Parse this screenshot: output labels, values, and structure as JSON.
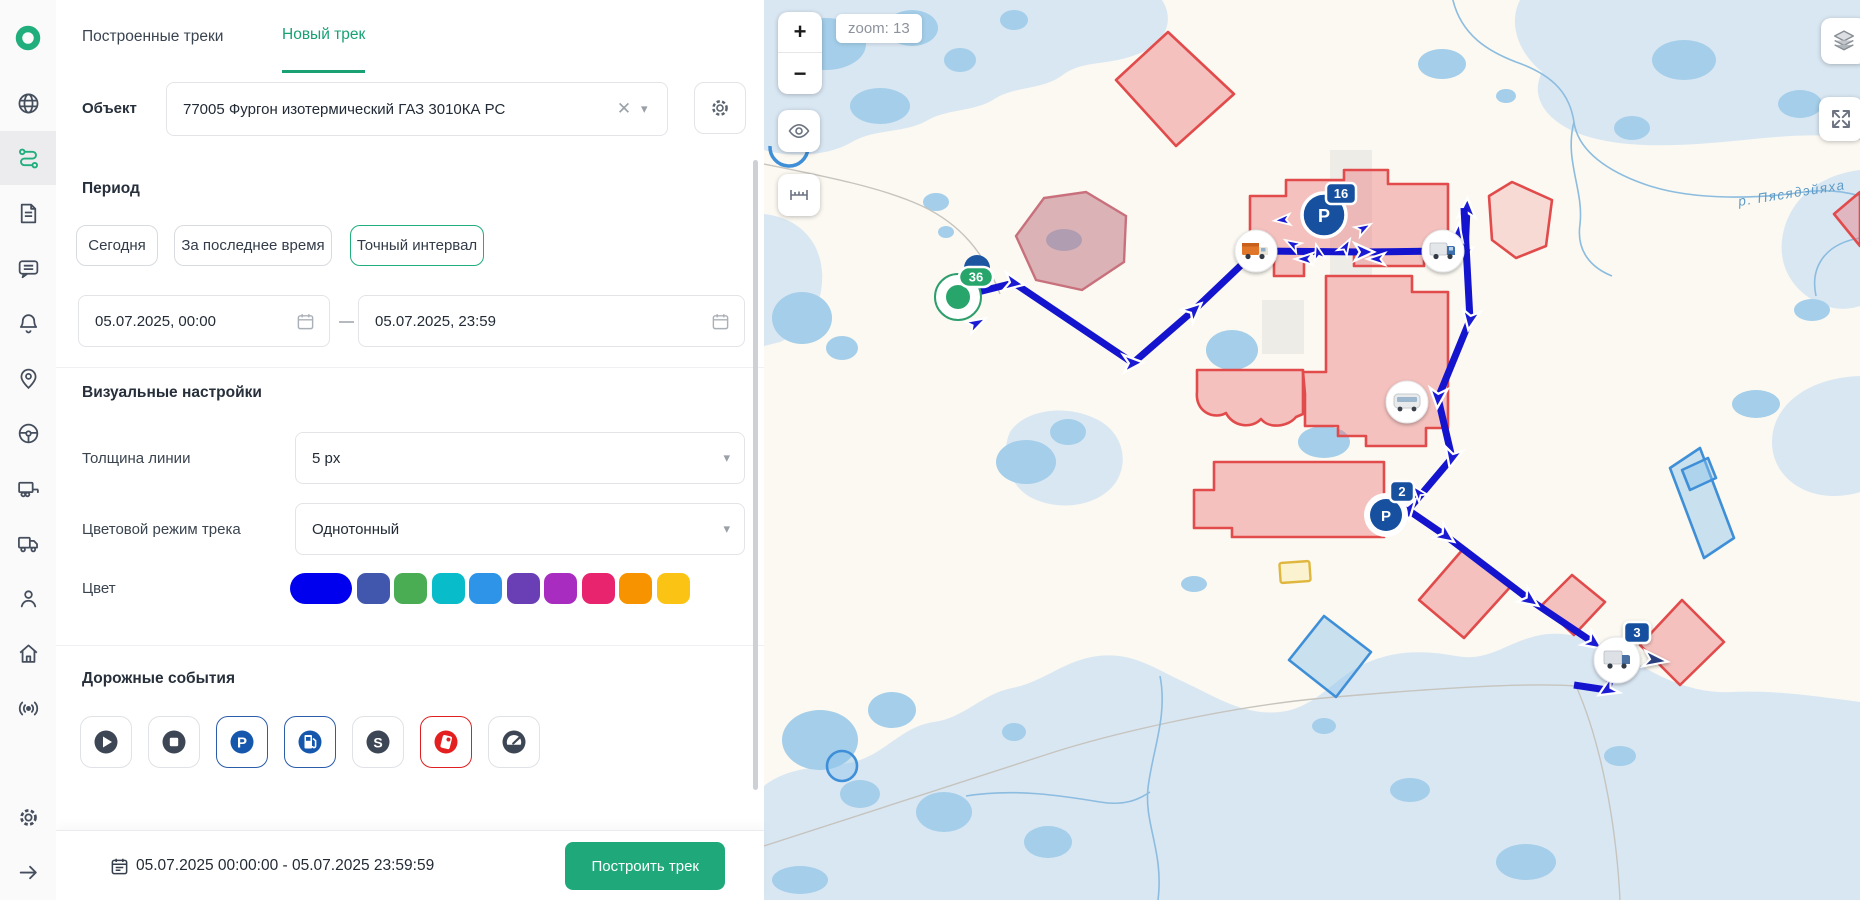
{
  "colors": {
    "accent_green": "#1fae7c",
    "track_blue": "#1414cf",
    "geofence_red": "#e14b4b",
    "geofence_blue": "#3f8fd8",
    "parking_navy": "#17509f"
  },
  "sidebar": {
    "icons": [
      "logo-ring",
      "globe-icon",
      "route-icon",
      "document-icon",
      "chat-icon",
      "bell-icon",
      "map-pin-icon",
      "steering-wheel-icon",
      "trailer-icon",
      "truck-icon",
      "user-icon",
      "home-icon",
      "signal-icon",
      "gear-icon",
      "arrow-right-icon"
    ],
    "active_item": "route-icon"
  },
  "tabs": {
    "built": "Построенные треки",
    "new": "Новый трек"
  },
  "object": {
    "label": "Объект",
    "value": "77005 Фургон изотермический ГАЗ 3010КА РС"
  },
  "period": {
    "heading": "Период",
    "today": "Сегодня",
    "recent": "За последнее время",
    "exact": "Точный интервал",
    "from": "05.07.2025, 00:00",
    "dash": "—",
    "to": "05.07.2025, 23:59"
  },
  "visual": {
    "heading": "Визуальные настройки",
    "line_label": "Толщина линии",
    "line_value": "5 px",
    "mode_label": "Цветовой режим трека",
    "mode_value": "Однотонный",
    "color_label": "Цвет",
    "swatches": [
      "#0000ee",
      "#4156ad",
      "#4aad53",
      "#09bcc9",
      "#2e94e8",
      "#6a3eb5",
      "#a82cc0",
      "#e8246e",
      "#f89300",
      "#fbc415"
    ],
    "selected_swatch_index": 0
  },
  "events": {
    "heading": "Дорожные события",
    "items": [
      {
        "icon": "play-icon",
        "selected": false
      },
      {
        "icon": "stop-icon",
        "selected": false
      },
      {
        "icon": "parking-icon",
        "selected": true
      },
      {
        "icon": "fuel-icon",
        "selected": true
      },
      {
        "icon": "s-event-icon",
        "selected": false
      },
      {
        "icon": "fuel-drain-icon",
        "selected": true
      },
      {
        "icon": "speedometer-icon",
        "selected": false
      }
    ]
  },
  "footer": {
    "range": "05.07.2025 00:00:00 - 05.07.2025 23:59:59",
    "build": "Построить трек"
  },
  "map": {
    "zoom_in": "+",
    "zoom_out": "−",
    "zoom_label": "zoom: 13",
    "river": "р. Пясядэйяха",
    "p_glyph": "P",
    "badges": {
      "start": "36",
      "p16": "16",
      "p2": "2",
      "truck3": "3"
    }
  }
}
